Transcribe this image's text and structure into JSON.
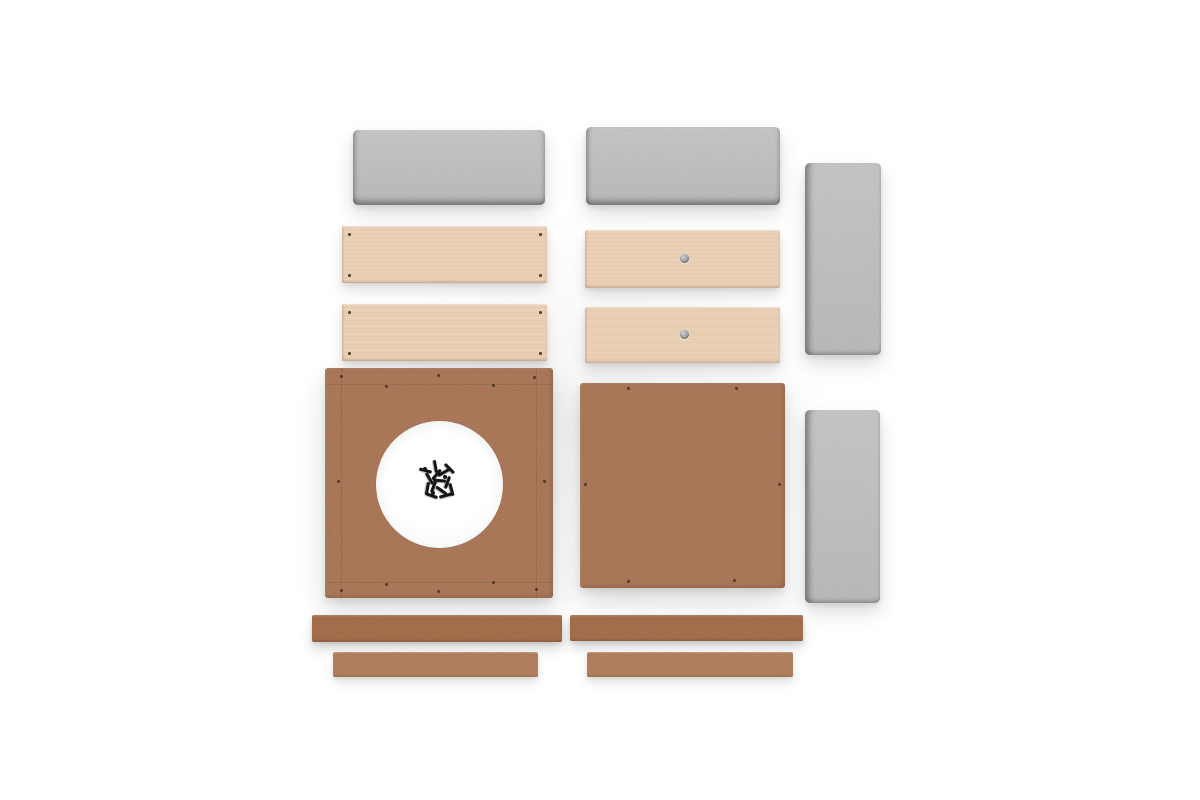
{
  "image": {
    "type": "product-photo-flat-lay",
    "subject": "Unassembled flat-pack kit parts arranged in two columns on a white studio background",
    "visible_text": []
  },
  "palette": {
    "background": "#ffffff",
    "foam-panel": "#d3d4d4",
    "foam-panel-light": "#dadbdb",
    "foam-panel-edge": "#97999a",
    "wood-plank": "#e9cfb4",
    "wood-grain": "#b07e52",
    "cork-board": "#c38a66",
    "strip-dark": "#bc7e57",
    "strip-light": "#c68f6a",
    "pilot-dot": "#3a2a1d",
    "cam-fitting": "#9aa0a3",
    "screw": "#141414",
    "cutout": "#ffffff"
  },
  "parts": {
    "foam_panels": [
      {
        "name": "foam-panel-top-left",
        "orientation": "horizontal"
      },
      {
        "name": "foam-panel-top-right",
        "orientation": "horizontal"
      },
      {
        "name": "foam-panel-right-upper",
        "orientation": "vertical"
      },
      {
        "name": "foam-panel-right-lower",
        "orientation": "vertical"
      }
    ],
    "wood_planks": [
      {
        "name": "plank-left-1",
        "detail": "small pilot holes near the four corners"
      },
      {
        "name": "plank-left-2",
        "detail": "small pilot holes near the four corners"
      },
      {
        "name": "plank-right-1",
        "detail": "one round metal cam fitting at center"
      },
      {
        "name": "plank-right-2",
        "detail": "one round metal cam fitting at center"
      }
    ],
    "boards": [
      {
        "name": "board-with-cutout",
        "detail": "square MDF board with large circular cutout, perimeter score lines and pilot holes; pile of black screws sits in the cutout"
      },
      {
        "name": "plain-board",
        "detail": "square MDF board with pilot holes along its edges"
      }
    ],
    "strips": [
      {
        "name": "strip-dark-left",
        "tone": "dark"
      },
      {
        "name": "strip-dark-right",
        "tone": "dark"
      },
      {
        "name": "strip-light-left",
        "tone": "light"
      },
      {
        "name": "strip-light-right",
        "tone": "light"
      }
    ],
    "hardware": {
      "name": "screw-pile",
      "detail": "small pile of black screws centered in the circular cutout"
    }
  }
}
